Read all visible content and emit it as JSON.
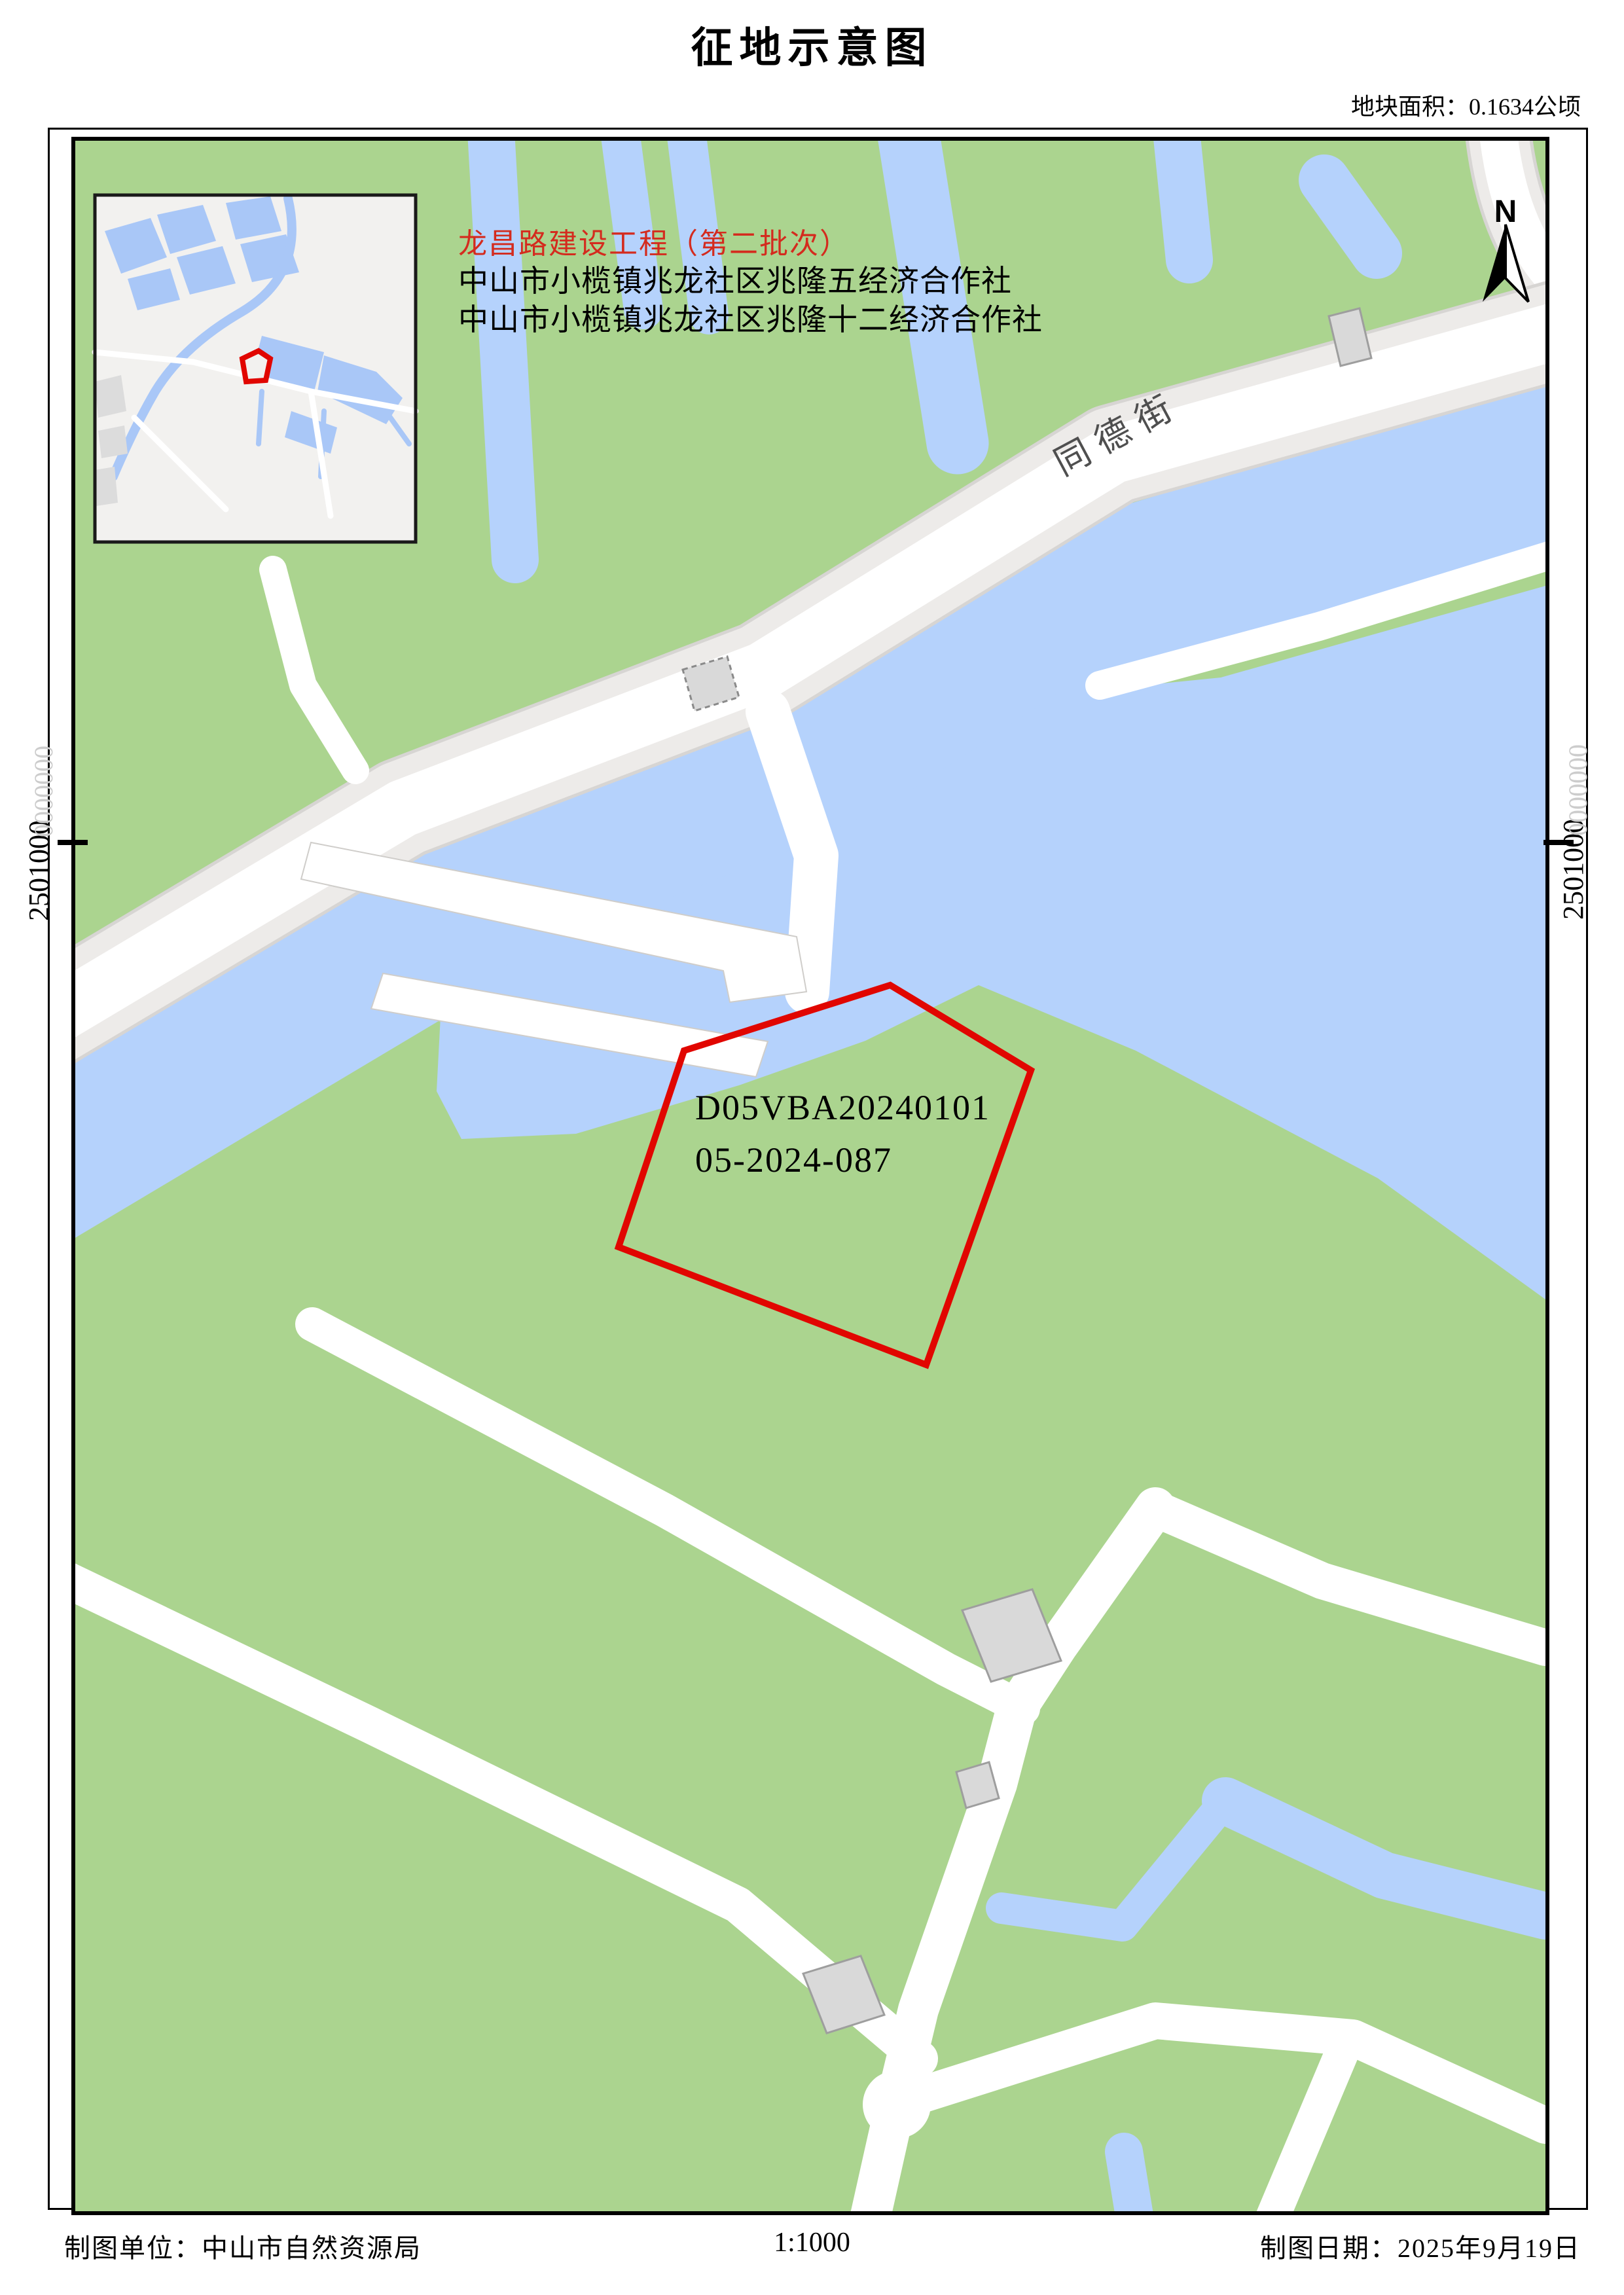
{
  "page": {
    "title": "征地示意图",
    "area_label": "地块面积：0.1634公顷"
  },
  "annotations": {
    "project_title": "龙昌路建设工程（第二批次）",
    "coop_line1": "中山市小榄镇兆龙社区兆隆五经济合作社",
    "coop_line2": "中山市小榄镇兆龙社区兆隆十二经济合作社",
    "parcel_code_line1": "D05VBA20240101",
    "parcel_code_line2": "05-2024-087",
    "road_label": "同德街",
    "north_label": "N",
    "coordinate_left": "2501000",
    "coordinate_right": "2501000",
    "coordinate_faded": "0000000"
  },
  "footer": {
    "agency": "制图单位：中山市自然资源局",
    "scale": "1:1000",
    "date": "制图日期：2025年9月19日"
  },
  "colors": {
    "parcel_red": "#e10600",
    "annotation_red": "#d42b1e",
    "land_green": "#abd48f",
    "water_blue": "#b5d2fc",
    "inset_water_blue": "#a9c7f7",
    "road_white": "#ffffff",
    "road_shoulder": "#edebe9",
    "road_casing": "#d7d5d3",
    "building_gray": "#d9d9d9"
  }
}
